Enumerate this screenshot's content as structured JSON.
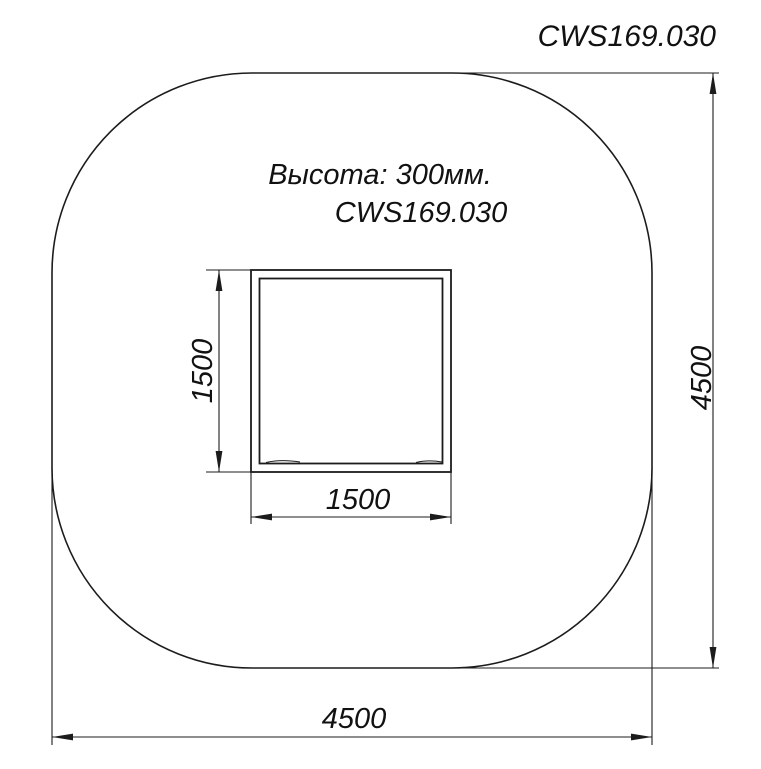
{
  "drawing": {
    "title": "CWS169.030",
    "note_height": "Высота: 300мм.",
    "note_part": "CWS169.030",
    "dim_inner_height": "1500",
    "dim_inner_width": "1500",
    "dim_outer_height": "4500",
    "dim_outer_width": "4500",
    "colors": {
      "line": "#1c1c1c",
      "text": "#111111",
      "background": "#ffffff"
    }
  }
}
